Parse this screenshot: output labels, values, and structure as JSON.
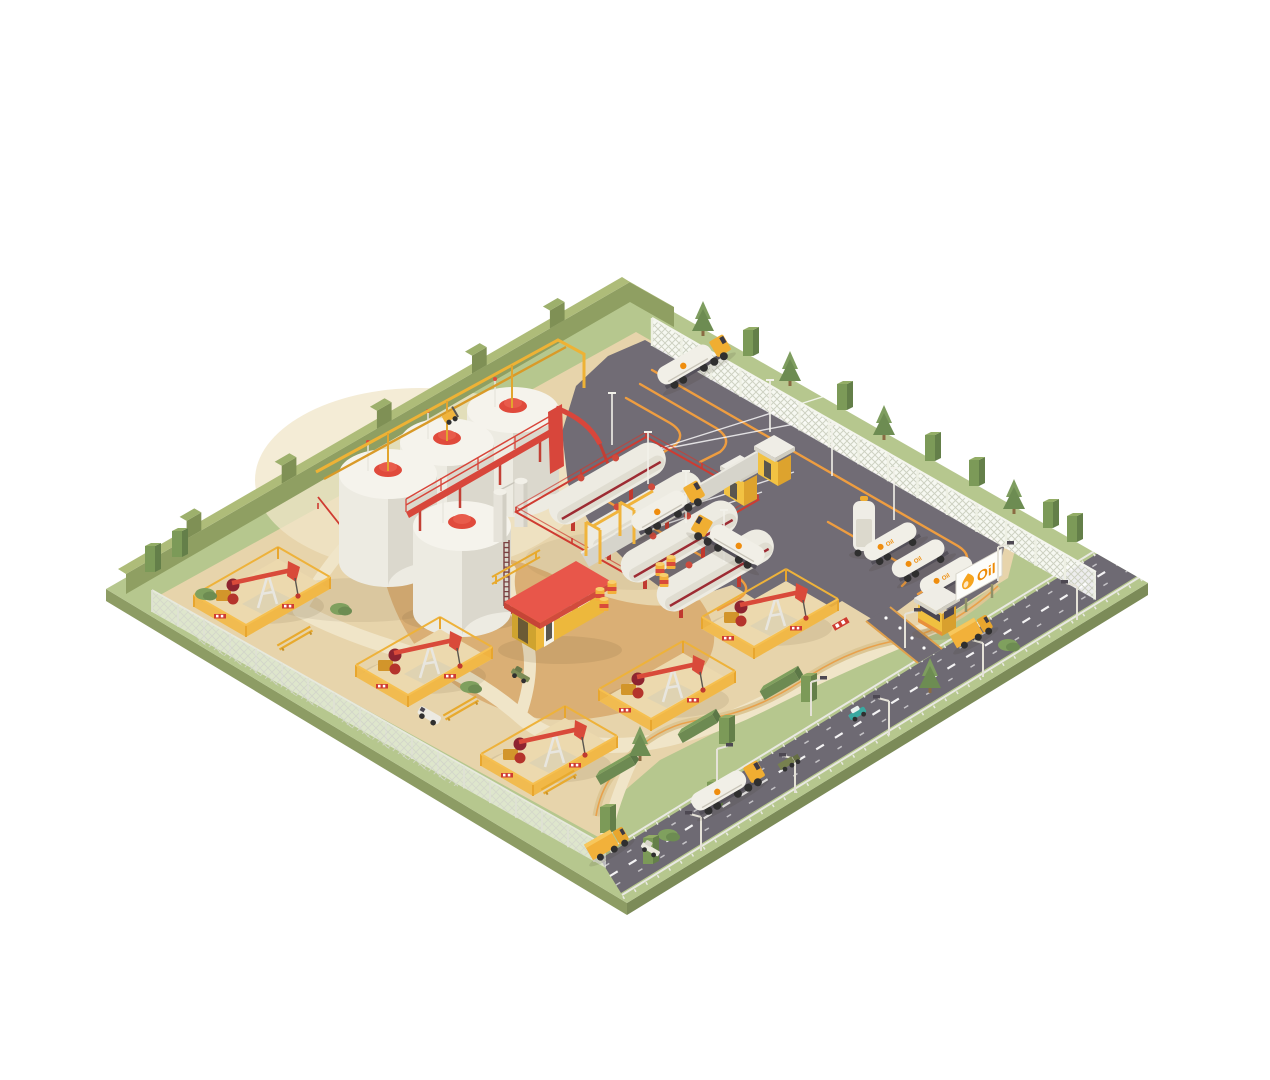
{
  "branding": {
    "billboard_text": "Oil",
    "truck_decal_text": "Oil"
  },
  "palette": {
    "bg": "#ffffff",
    "grass": "#b6c78e",
    "grass-dark": "#9db173",
    "hedge": "#8f9f62",
    "hedge-top": "#aebc79",
    "hedge-dark": "#7d8e54",
    "sand": "#e7d4ab",
    "sand-light": "#f0e5c8",
    "sand-dark": "#d8ab6f",
    "asphalt": "#716c75",
    "road": "#6e6a73",
    "lane-orange": "#ee9d40",
    "tank-white": "#edebe2",
    "tank-shade": "#d9d6cb",
    "red": "#d8463b",
    "dark-red": "#9d2b33",
    "yellow": "#f0b43c",
    "yellow-dark": "#d2952b",
    "tree": "#7b9a57",
    "tree-dark": "#5f7d46",
    "logo-orange": "#ee8a05"
  },
  "inventory": {
    "storage_tanks": 4,
    "process_columns": 2,
    "horizontal_tanks": 4,
    "pumpjack_pens": 5,
    "truck_loading_bays": 2,
    "tanker_trucks_on_site": 3,
    "parked_tank_trailers": 4,
    "office_building": 1,
    "guard_booth": 1,
    "billboard": 1,
    "oil_barrels": 6,
    "highway_vehicles": 6,
    "service_vehicles": 3
  }
}
